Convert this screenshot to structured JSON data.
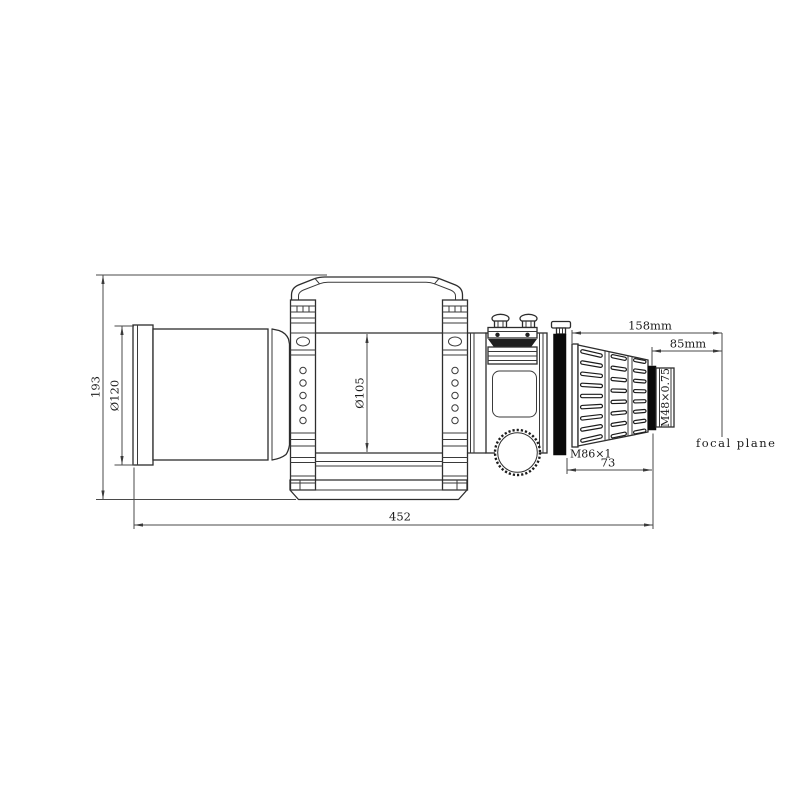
{
  "dims": {
    "overall_height": "193",
    "dew_shield_diameter": "Ø120",
    "tube_diameter": "Ø105",
    "overall_length": "452",
    "backfocus_total": "158mm",
    "backfocus_from_adapter": "85mm",
    "drawtube_length": "73",
    "front_thread": "M86×1",
    "rear_thread": "M48×0.75",
    "focal_plane_label": "focal plane"
  },
  "colors": {
    "background": "#ffffff",
    "outline": "#2d2d2d",
    "dimension_line": "#4a4a4a",
    "filled_band": "#0a0a0a",
    "text": "#1c1c1c"
  }
}
